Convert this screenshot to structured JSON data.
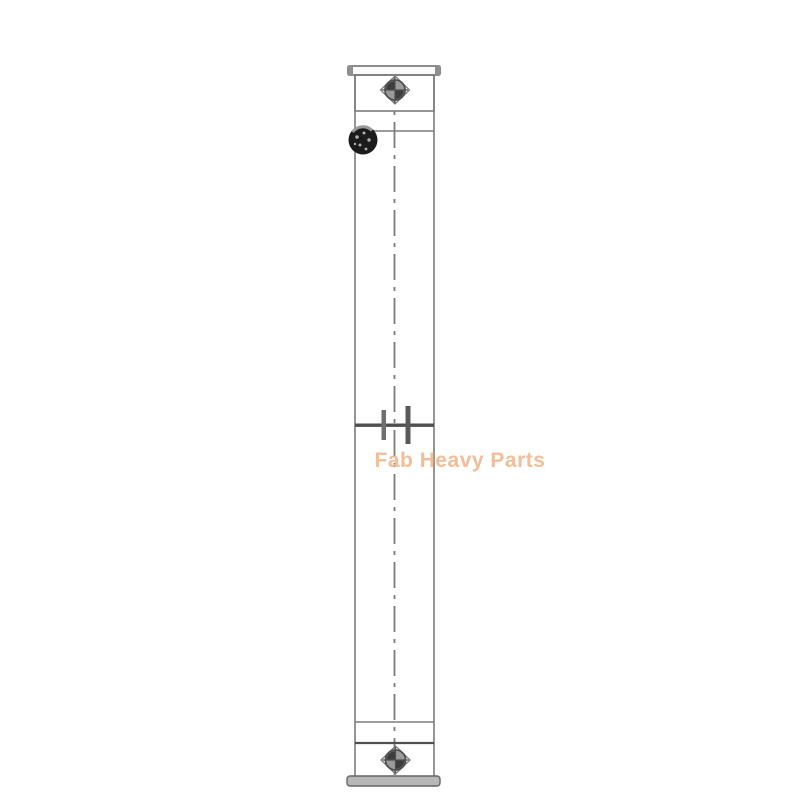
{
  "image": {
    "kind": "technical-line-drawing-product-image",
    "watermark": {
      "text": "Fab Heavy Parts"
    }
  },
  "icons": {
    "top_bolt": "bolt-head-icon",
    "bottom_bolt": "bolt-head-icon",
    "filler_plug": "filler-plug-icon"
  },
  "colors": {
    "background": "#ffffff",
    "line": "#7c7c7c",
    "line_dark": "#4f4f4f",
    "plug": "#1b1b1b",
    "watermark": "#f3bd97"
  }
}
